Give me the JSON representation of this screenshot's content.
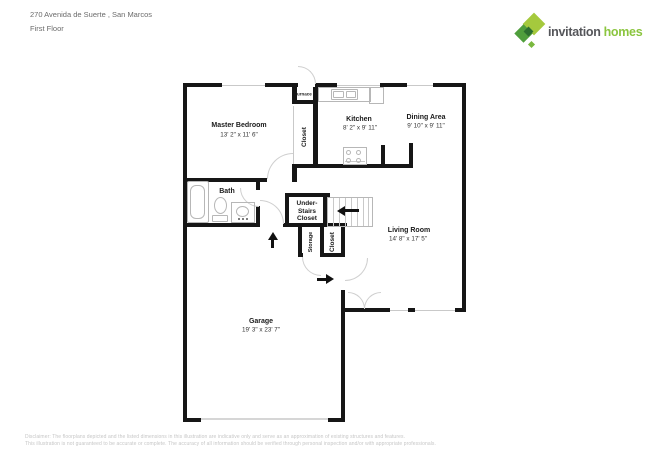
{
  "header": {
    "address": "270 Avenida de Suerte , San Marcos",
    "floor": "First Floor"
  },
  "logo": {
    "word1": "invitation",
    "word2": "homes",
    "colors": {
      "word1_color": "#55565a",
      "word2_color": "#8bc53f",
      "diamond_light": "#a5c93d",
      "diamond_mid": "#4f9e3c",
      "diamond_dark": "#2c6f2f",
      "diamond_small": "#7ab83e"
    }
  },
  "rooms": {
    "master": {
      "label": "Master Bedroom",
      "dims": "13' 2\" x 11' 6\""
    },
    "kitchen": {
      "label": "Kitchen",
      "dims": "8' 2\" x 9' 11\""
    },
    "dining": {
      "label": "Dining Area",
      "dims": "9' 10\" x 9' 11\""
    },
    "living": {
      "label": "Living Room",
      "dims": "14' 8\" x 17' 5\""
    },
    "garage": {
      "label": "Garage",
      "dims": "19' 3\" x 23' 7\""
    },
    "bath": {
      "label": "Bath"
    },
    "furnace": {
      "label": "Furnace"
    },
    "closet_hall": {
      "label": "Closet"
    },
    "understairs": {
      "label": "Under-\nStairs\nCloset"
    },
    "storage": {
      "label": "Storage"
    },
    "closet_entry": {
      "label": "Closet"
    }
  },
  "footer": {
    "line1": "Disclaimer: The floorplans depicted and the listed dimensions in this illustration are indicative only and serve as an approximation of existing structures and features.",
    "line2": "This illustration is not guaranteed to be accurate or complete. The accuracy of all information should be verified through personal inspection and/or with appropriate professionals."
  }
}
